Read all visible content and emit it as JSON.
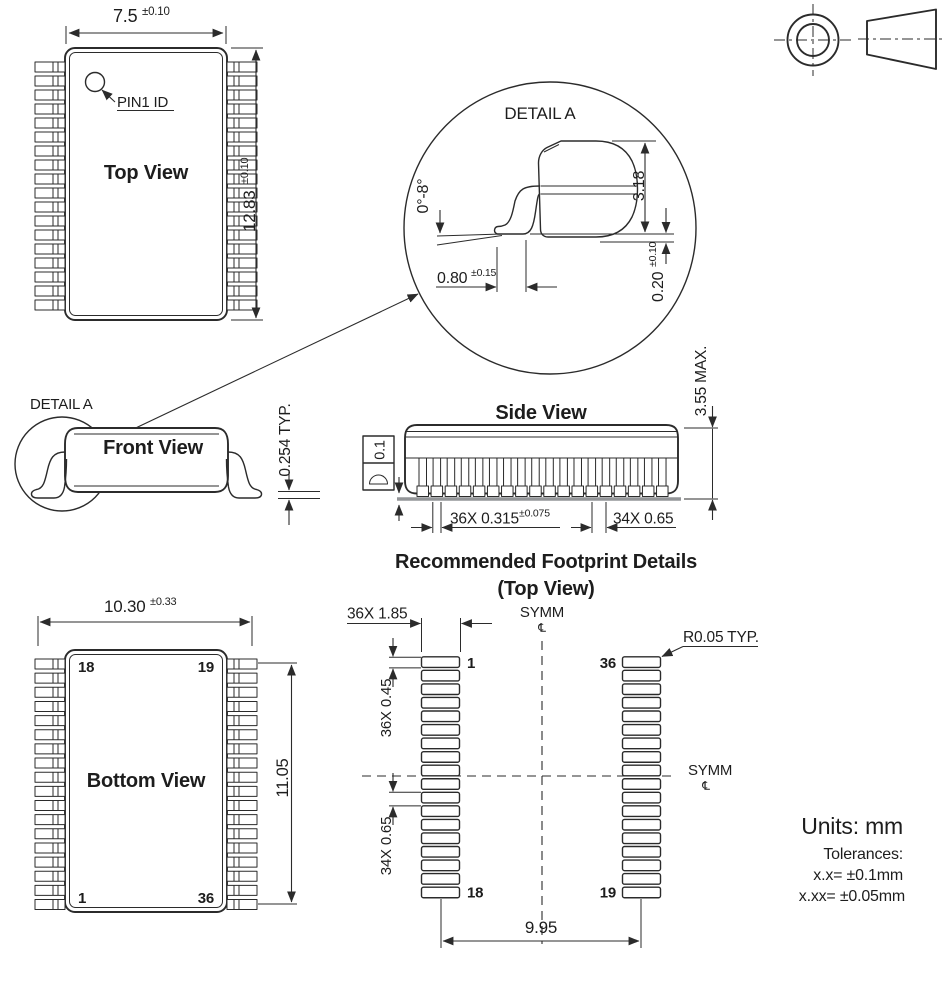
{
  "top_view": {
    "title": "Top View",
    "pin1_label": "PIN1 ID",
    "width": "7.5",
    "width_tol": "±0.10",
    "height": "12.83",
    "height_tol": "±0.10"
  },
  "detail_a": {
    "title": "DETAIL A",
    "lead_angle": "0°-8°",
    "body_height": "3.18",
    "foot_length": "0.80",
    "foot_length_tol": "±0.15",
    "lead_thickness": "0.20",
    "lead_thickness_tol": "±0.10"
  },
  "front_view": {
    "title": "Front View",
    "detail_callout": "DETAIL A",
    "foot_thickness": "0.254 TYP."
  },
  "side_view": {
    "title": "Side View",
    "flatness": "0.1",
    "lead_width": "36X 0.315",
    "lead_width_tol": "±0.075",
    "lead_pitch": "34X 0.65",
    "package_height": "3.55 MAX."
  },
  "footprint": {
    "title_line1": "Recommended Footprint Details",
    "title_line2": "(Top View)",
    "pad_length": "36X 1.85",
    "pad_width": "36X 0.45",
    "pad_pitch": "34X 0.65",
    "pad_corner_radius": "R0.05 TYP.",
    "column_span": "9.95",
    "symm_label": "SYMM",
    "centerline_symbol": "℄",
    "pad_1": "1",
    "pad_18": "18",
    "pad_19": "19",
    "pad_36": "36"
  },
  "bottom_view": {
    "title": "Bottom View",
    "width": "10.30",
    "width_tol": "±0.33",
    "lead_span": "11.05",
    "pin_top_left": "18",
    "pin_top_right": "19",
    "pin_bottom_left": "1",
    "pin_bottom_right": "36"
  },
  "notes": {
    "units": "Units: mm",
    "tolerances_title": "Tolerances:",
    "tolerance_1dp": "x.x= ±0.1mm",
    "tolerance_2dp": "x.xx= ±0.05mm"
  },
  "counts": {
    "pins_per_side": 18,
    "side_view_leads": 18,
    "footprint_pads_per_column": 18
  },
  "colors": {
    "line": "#2b2b2b",
    "seating_plane": "#939598",
    "background": "#ffffff"
  }
}
